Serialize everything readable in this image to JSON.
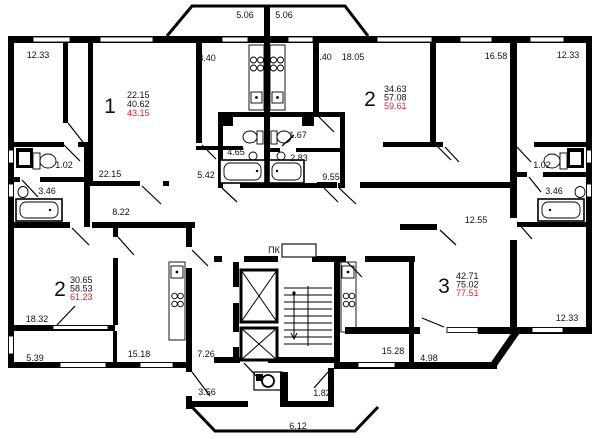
{
  "title": "apartment-floor-plan",
  "colors": {
    "wall": "#000000",
    "area_highlight": "#e8202a",
    "background": "#ffffff"
  },
  "apartments": [
    {
      "number": "1",
      "living": "22.15",
      "total": "40.62",
      "total_with_balcony": "43.15"
    },
    {
      "number": "2",
      "living": "34.63",
      "total": "57.08",
      "total_with_balcony": "59.61"
    },
    {
      "number": "2",
      "living": "30.65",
      "total": "58.53",
      "total_with_balcony": "61.23"
    },
    {
      "number": "3",
      "living": "42.71",
      "total": "75.02",
      "total_with_balcony": "77.51"
    }
  ],
  "labels": {
    "balcony_tl": "5.06",
    "balcony_tr": "5.06",
    "room_tl": "12.33",
    "kitchen_apt1": "8.40",
    "kitchen_apt2": "8.40",
    "room_1805": "18.05",
    "room_1658": "16.58",
    "room_tr": "12.33",
    "wc_left": "1.02",
    "bath_left": "3.46",
    "room_2215": "22.15",
    "hall_822": "8.22",
    "corr_542": "5.42",
    "bath_465": "4.65",
    "wc_167": "1.67",
    "bath_283": "2.83",
    "corr_955": "9.55",
    "wc_right": "1.02",
    "bath_right": "3.46",
    "corr_1255": "12.55",
    "room_1832": "18.32",
    "balcony_539": "5.39",
    "kitchen_1518": "15.18",
    "corr_726": "7.26",
    "vest_356": "3.56",
    "vest_182": "1.82",
    "porch_612": "6.12",
    "kitchen_1528": "15.28",
    "balcony_498": "4.98",
    "room_br": "12.33",
    "fire_cabinet": "ПК"
  }
}
